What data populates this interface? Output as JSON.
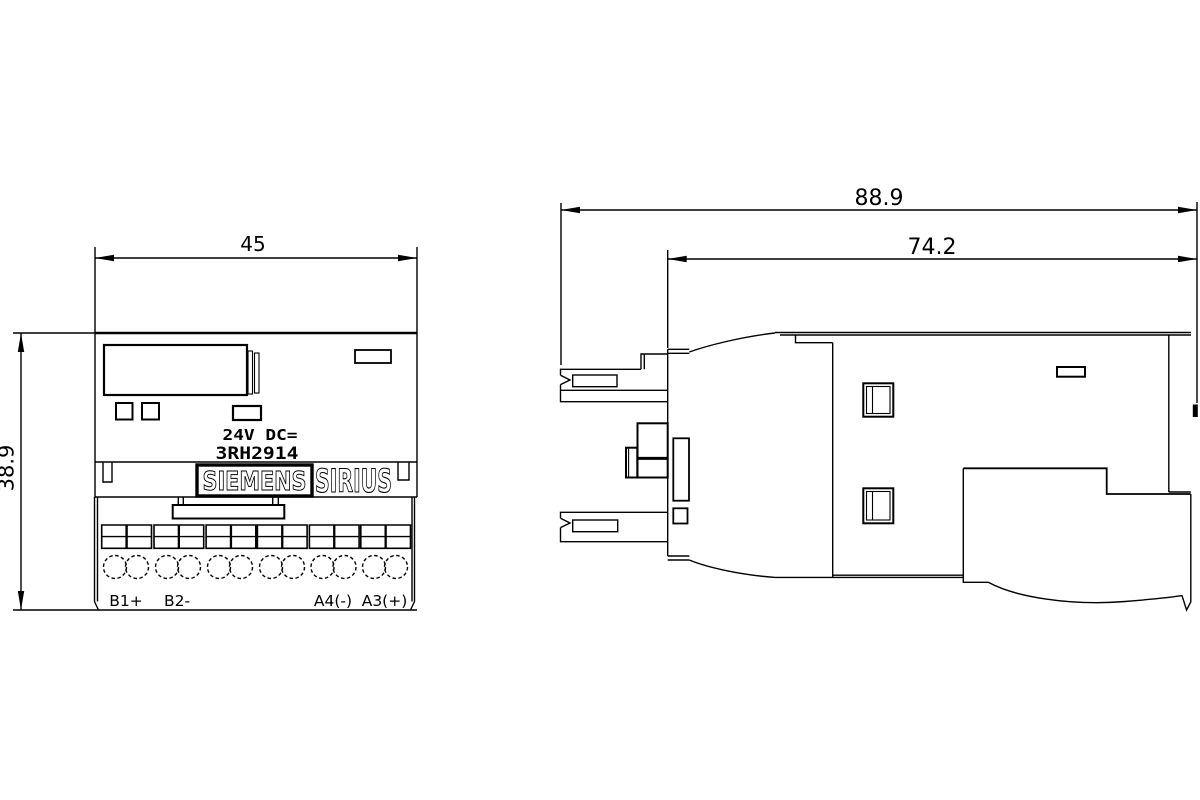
{
  "drawing": {
    "front_view": {
      "width_dim": "45",
      "height_dim": "38.9",
      "supply_label": "24V DC=",
      "product_code": "3RH2914",
      "brand_label": "SIEMENS",
      "series_label": "SIRIUS",
      "terminal_labels": [
        "B1+",
        "B2-",
        "A4(-)",
        "A3(+)"
      ]
    },
    "side_view": {
      "overall_depth_dim": "88.9",
      "body_depth_dim": "74.2"
    },
    "colors": {
      "line": "#000000",
      "background": "#ffffff"
    }
  }
}
